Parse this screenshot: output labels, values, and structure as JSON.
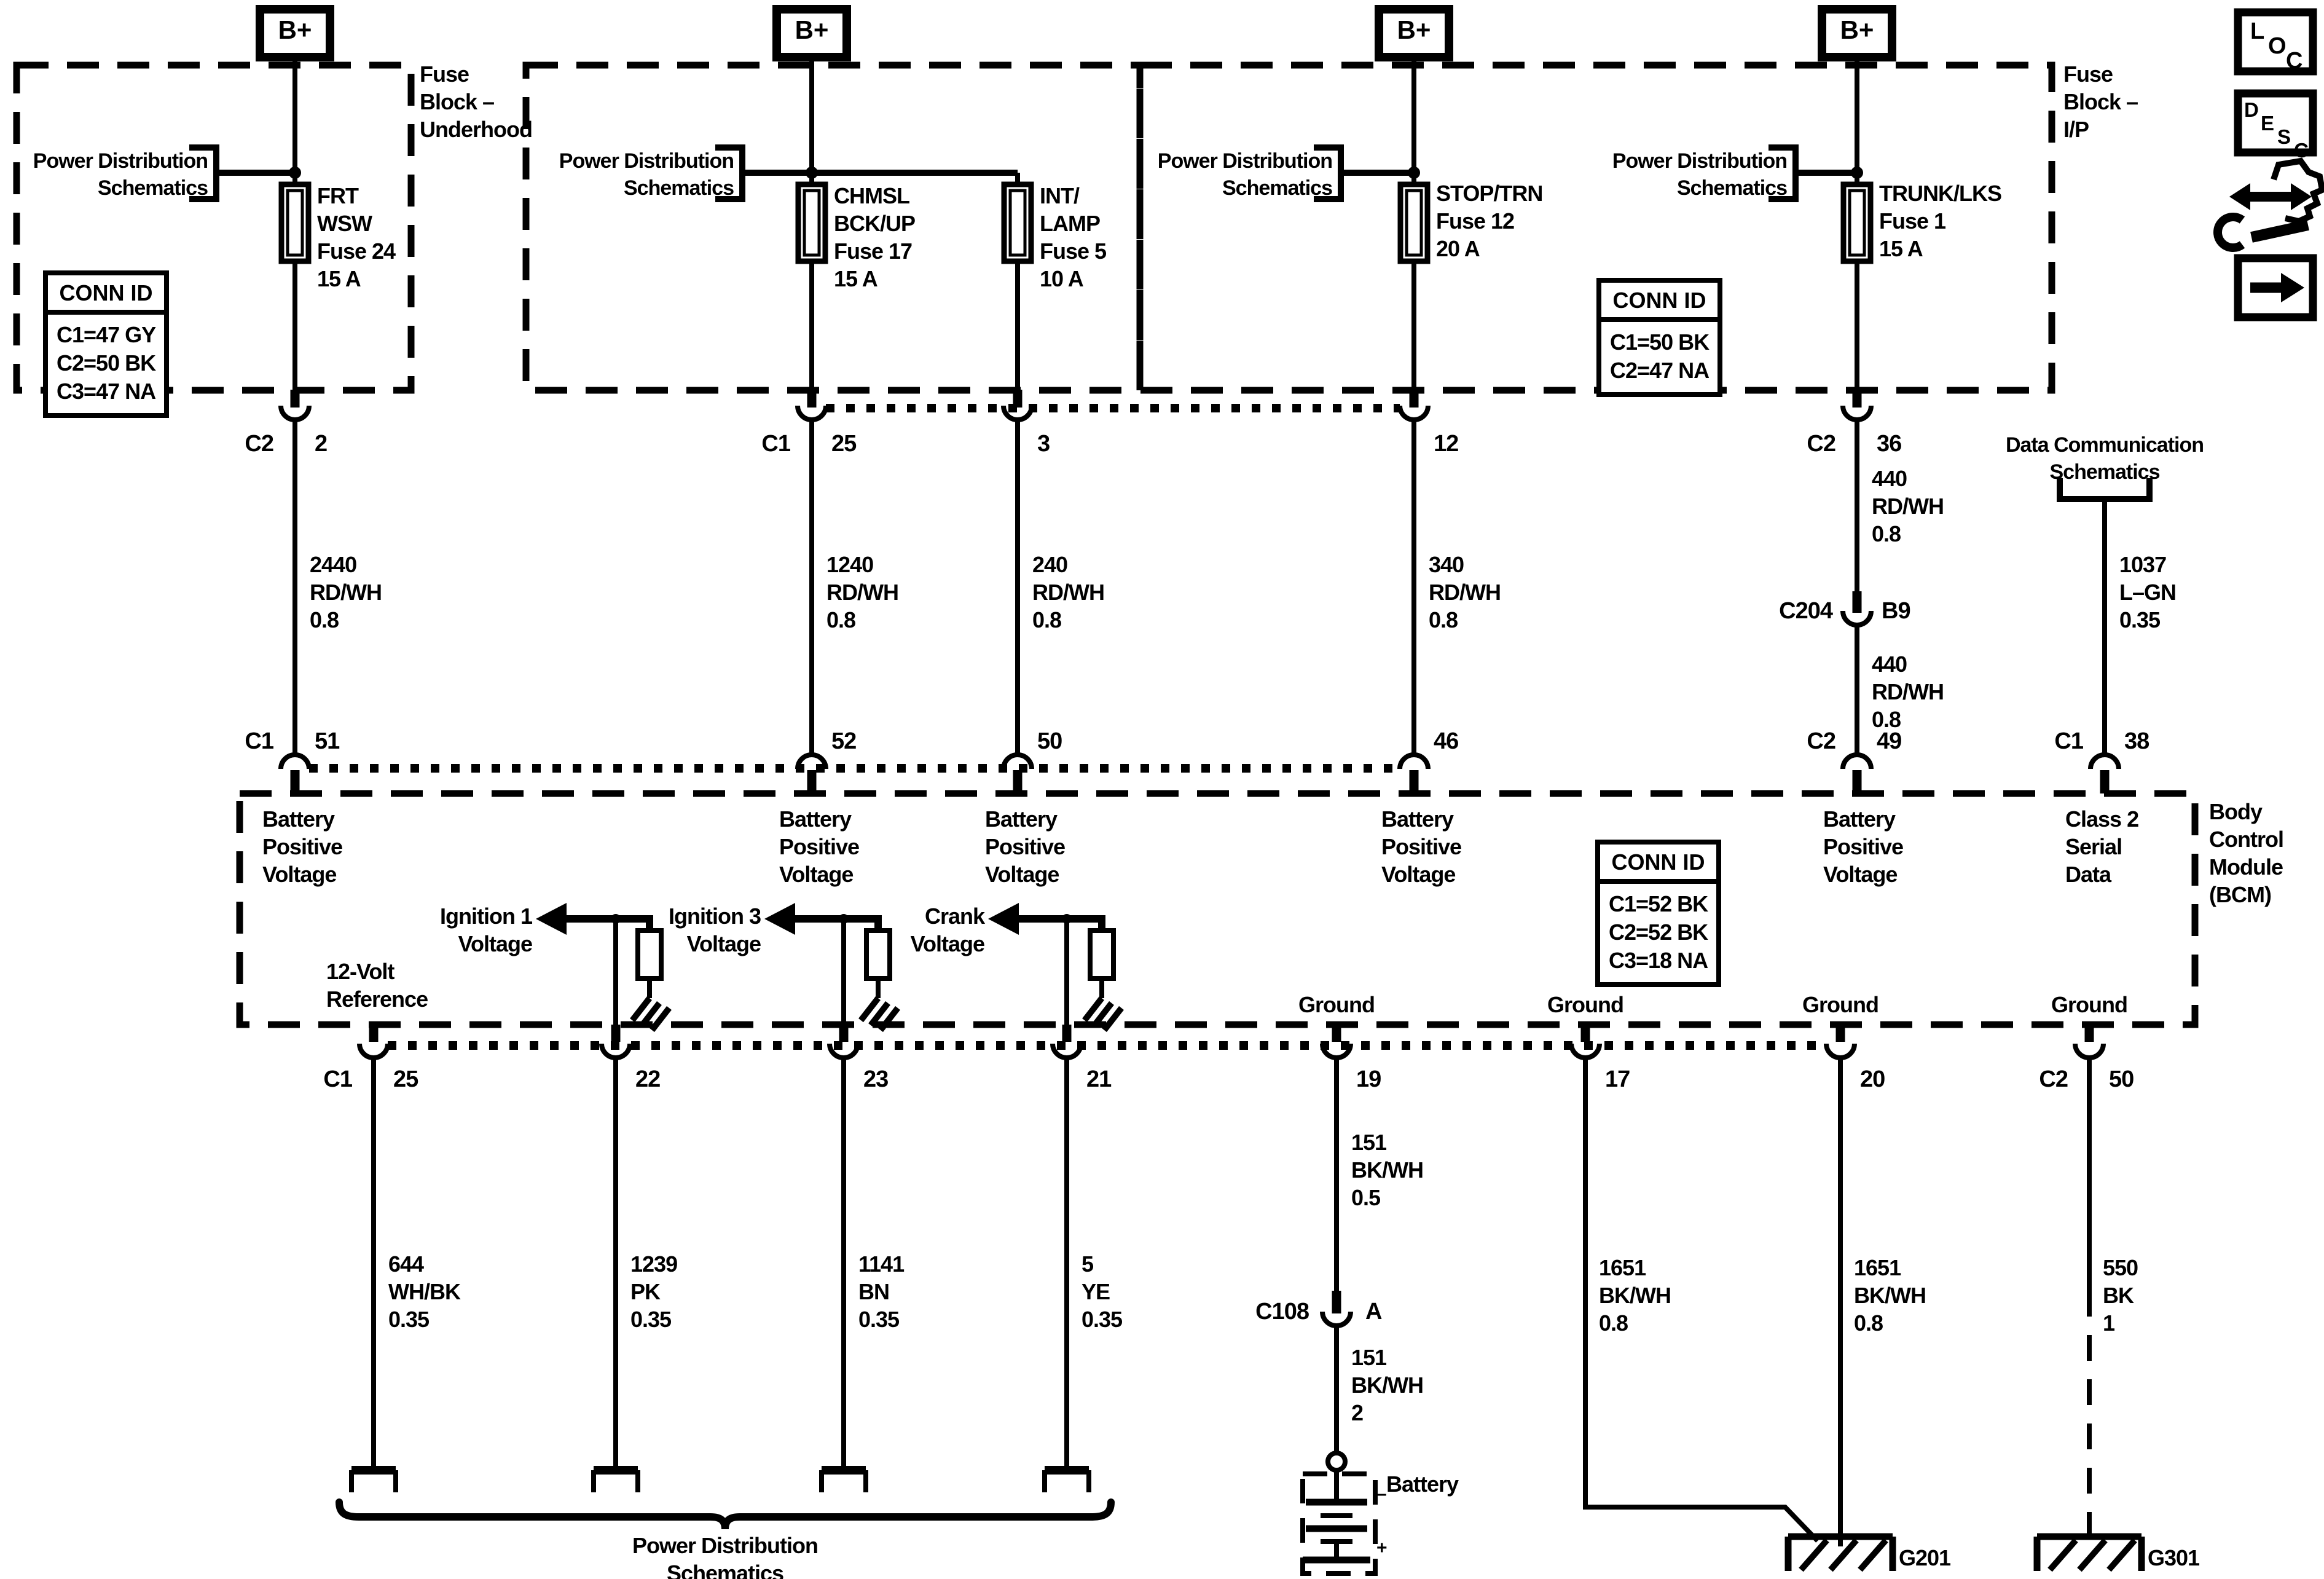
{
  "colors": {
    "line": "#000000",
    "background": "#ffffff"
  },
  "icons": {
    "loc_letters": [
      "L",
      "O",
      "C"
    ],
    "desc_letters": [
      "D",
      "E",
      "S",
      "C"
    ],
    "wrench": "wrench-double-arrow-icon",
    "arrow": "forward-arrow-icon"
  },
  "terminals": {
    "b_plus": "B+"
  },
  "fuse_blocks": {
    "underhood_label": "Fuse\nBlock –\nUnderhood",
    "ip_label": "Fuse\nBlock –\nI/P",
    "power_dist_ref": "Power Distribution\nSchematics",
    "conn_id_title": "CONN ID",
    "underhood_conn_rows": "C1=47 GY\nC2=50 BK\nC3=47 NA",
    "ip_conn_rows": "C1=50 BK\nC2=47 NA",
    "fuse_frt_wsw": "FRT\nWSW\nFuse 24\n15 A",
    "fuse_chmsl": "CHMSL\nBCK/UP\nFuse 17\n15 A",
    "fuse_int_lamp": "INT/\nLAMP\nFuse 5\n10 A",
    "fuse_stop_trn": "STOP/TRN\nFuse 12\n20 A",
    "fuse_trunk_lks": "TRUNK/LKS\nFuse 1\n15 A"
  },
  "pins": {
    "c1": "C1",
    "c2": "C2",
    "p2": "2",
    "p25": "25",
    "p3": "3",
    "p12": "12",
    "p36": "36",
    "p51": "51",
    "p52": "52",
    "p50": "50",
    "p46": "46",
    "p49": "49",
    "p38": "38",
    "p22": "22",
    "p23": "23",
    "p21": "21",
    "p19": "19",
    "p17": "17",
    "p20": "20",
    "c204": "C204",
    "b9": "B9",
    "c108": "C108",
    "a": "A"
  },
  "wire_labels": {
    "w2440": "2440\nRD/WH\n0.8",
    "w1240": "1240\nRD/WH\n0.8",
    "w240": "240\nRD/WH\n0.8",
    "w340": "340\nRD/WH\n0.8",
    "w440": "440\nRD/WH\n0.8",
    "w1037": "1037\nL–GN\n0.35",
    "w644": "644\nWH/BK\n0.35",
    "w1239": "1239\nPK\n0.35",
    "w1141": "1141\nBN\n0.35",
    "w5": "5\nYE\n0.35",
    "w151a": "151\nBK/WH\n0.5",
    "w151b": "151\nBK/WH\n2",
    "w1651": "1651\nBK/WH\n0.8",
    "w550": "550\nBK\n1"
  },
  "bcm": {
    "battery_positive": "Battery\nPositive\nVoltage",
    "class2": "Class 2\nSerial\nData",
    "module_name": "Body\nControl\nModule\n(BCM)",
    "conn_rows": "C1=52 BK\nC2=52 BK\nC3=18 NA",
    "ref_12v": "12-Volt\nReference",
    "ignition1": "Ignition 1\nVoltage",
    "ignition3": "Ignition 3\nVoltage",
    "crank": "Crank\nVoltage",
    "ground": "Ground"
  },
  "other": {
    "data_comm": "Data Communication\nSchematics",
    "power_dist_bottom": "Power Distribution\nSchematics",
    "battery": "Battery",
    "minus": "–",
    "plus": "+",
    "g201": "G201",
    "g301": "G301"
  }
}
